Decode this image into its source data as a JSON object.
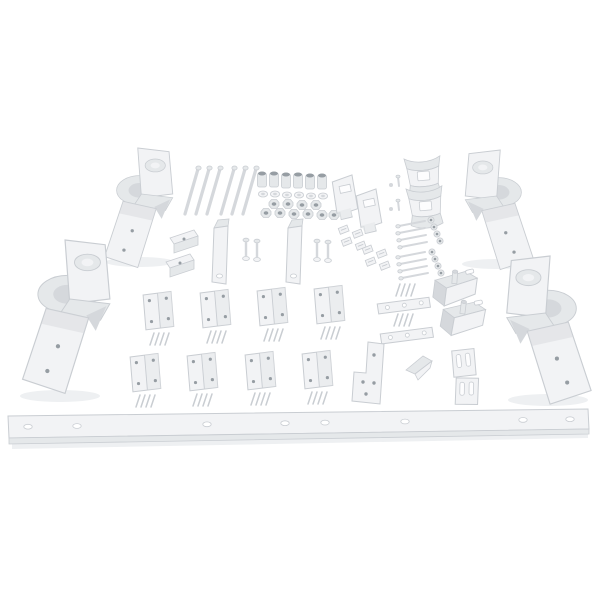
{
  "image": {
    "alt": "Product photo of a white powder-coated mounting hardware kit laid out on a white background: four corner bracket assemblies, a long drilled mounting rail, eight hinge plates with screws, straps, clips, angle brackets, bolts, spacers, washers and nuts",
    "width": 600,
    "height": 600
  },
  "colors": {
    "background": "#ffffff",
    "part_light": "#f2f3f5",
    "part_mid": "#e5e8ea",
    "part_shade": "#d5d8dc",
    "part_dark": "#969da3",
    "part_edge": "#c9cdd2",
    "shadow": "#eef0f2"
  },
  "parts": [
    {
      "name": "corner-bracket-assembly",
      "quantity": 4
    },
    {
      "name": "long-bolt",
      "quantity": 6
    },
    {
      "name": "spacer-bushing",
      "quantity": 6
    },
    {
      "name": "flat-washer",
      "quantity": 6
    },
    {
      "name": "hex-nut",
      "quantity": 10
    },
    {
      "name": "slotted-p-bracket",
      "quantity": 2
    },
    {
      "name": "saddle-bracket",
      "quantity": 2
    },
    {
      "name": "small-screw-with-nut",
      "quantity": 2
    },
    {
      "name": "l-angle-clip",
      "quantity": 2
    },
    {
      "name": "vertical-strap-bracket",
      "quantity": 2
    },
    {
      "name": "hex-bolt-with-washer",
      "quantity": 4
    },
    {
      "name": "u-nut-clip",
      "quantity": 8
    },
    {
      "name": "self-tapping-screw",
      "quantity": 8
    },
    {
      "name": "small-hex-nut",
      "quantity": 8
    },
    {
      "name": "hinge-plate",
      "quantity": 8
    },
    {
      "name": "hinge-plate-screw",
      "quantity": 32
    },
    {
      "name": "three-hole-strap",
      "quantity": 2
    },
    {
      "name": "stud-angle-bracket",
      "quantity": 2
    },
    {
      "name": "notched-plate",
      "quantity": 1
    },
    {
      "name": "chevron-bracket",
      "quantity": 1
    },
    {
      "name": "slotted-end-plate",
      "quantity": 2
    },
    {
      "name": "main-mounting-rail",
      "quantity": 1,
      "hole_count": 8
    }
  ]
}
